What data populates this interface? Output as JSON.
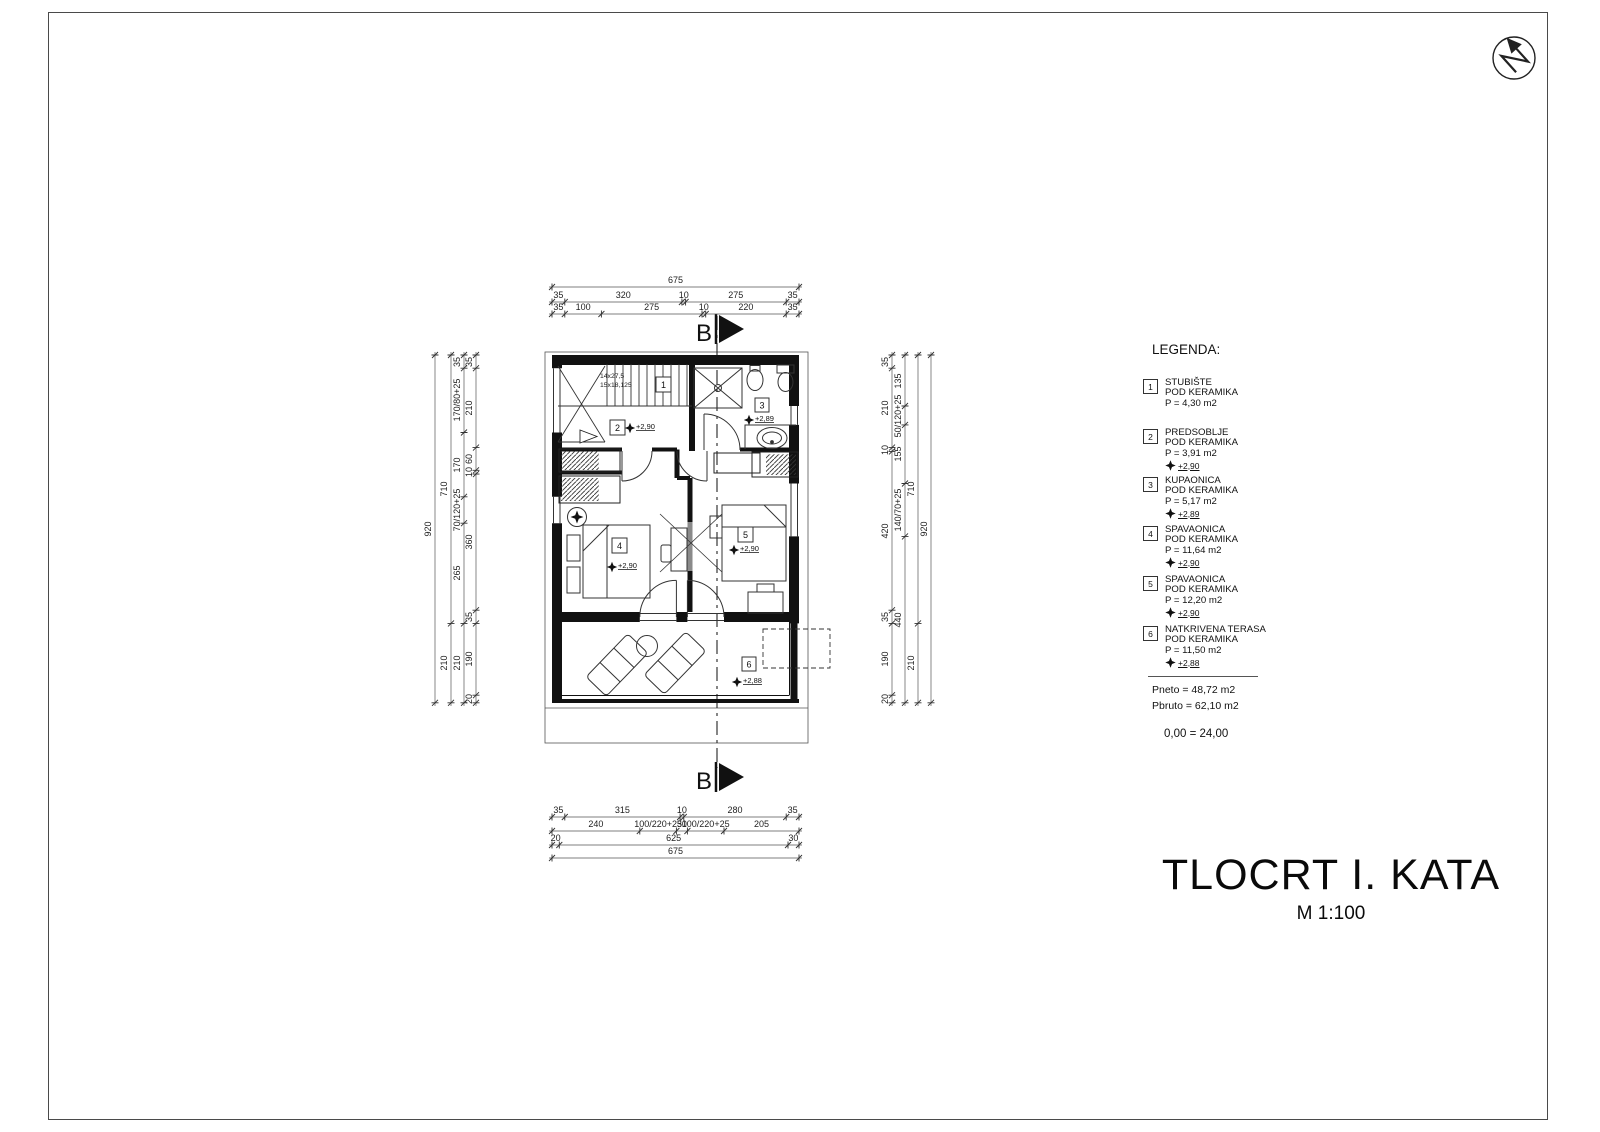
{
  "titleblock": {
    "title": "TLOCRT I. KATA",
    "scale": "M 1:100"
  },
  "section": {
    "letter": "B"
  },
  "legend": {
    "heading": "LEGENDA:",
    "items": [
      {
        "num": "1",
        "name": "STUBIŠTE",
        "floor": "POD KERAMIKA",
        "area": "P = 4,30 m2",
        "level": ""
      },
      {
        "num": "2",
        "name": "PREDSOBLJE",
        "floor": "POD KERAMIKA",
        "area": "P = 3,91 m2",
        "level": "+2,90"
      },
      {
        "num": "3",
        "name": "KUPAONICA",
        "floor": "POD KERAMIKA",
        "area": "P = 5,17 m2",
        "level": "+2,89"
      },
      {
        "num": "4",
        "name": "SPAVAONICA",
        "floor": "POD KERAMIKA",
        "area": "P = 11,64 m2",
        "level": "+2,90"
      },
      {
        "num": "5",
        "name": "SPAVAONICA",
        "floor": "POD KERAMIKA",
        "area": "P = 12,20 m2",
        "level": "+2,90"
      },
      {
        "num": "6",
        "name": "NATKRIVENA TERASA",
        "floor": "POD KERAMIKA",
        "area": "P = 11,50 m2",
        "level": "+2,88"
      }
    ],
    "pneto": "Pneto = 48,72 m2",
    "pbruto": "Pbruto = 62,10 m2",
    "datum": "0,00 = 24,00"
  },
  "plan": {
    "stair_note_1": "14x27,5",
    "stair_note_2": "15x18,125",
    "rooms": [
      {
        "num": "1",
        "level": ""
      },
      {
        "num": "2",
        "level": "+2,90"
      },
      {
        "num": "3",
        "level": "+2,89"
      },
      {
        "num": "4",
        "level": "+2,90"
      },
      {
        "num": "5",
        "level": "+2,90"
      },
      {
        "num": "6",
        "level": "+2,88"
      }
    ]
  },
  "dims": {
    "top": [
      [
        "675"
      ],
      [
        "35",
        "320",
        "10",
        "275",
        "35"
      ],
      [
        "35",
        "100",
        "275",
        "10",
        "220",
        "35"
      ]
    ],
    "bottom": [
      [
        "35",
        "315",
        "10",
        "280",
        "35"
      ],
      [
        "240",
        "100/220+25",
        "30",
        "100/220+25",
        "205"
      ],
      [
        "20",
        "625",
        "30"
      ],
      [
        "675"
      ]
    ],
    "left": [
      [
        "920"
      ],
      [
        "710",
        "210"
      ],
      [
        "35",
        "170/80+25",
        "170",
        "70/120+25",
        "265",
        "210"
      ],
      [
        "35",
        "210",
        "60",
        "10",
        "360",
        "35",
        "190",
        "20"
      ]
    ],
    "right": [
      [
        "35",
        "210",
        "10",
        "420",
        "35",
        "190",
        "20"
      ],
      [
        "135",
        "50/120+25",
        "155",
        "140/70+25",
        "440"
      ],
      [
        "710",
        "210"
      ],
      [
        "920"
      ]
    ]
  }
}
